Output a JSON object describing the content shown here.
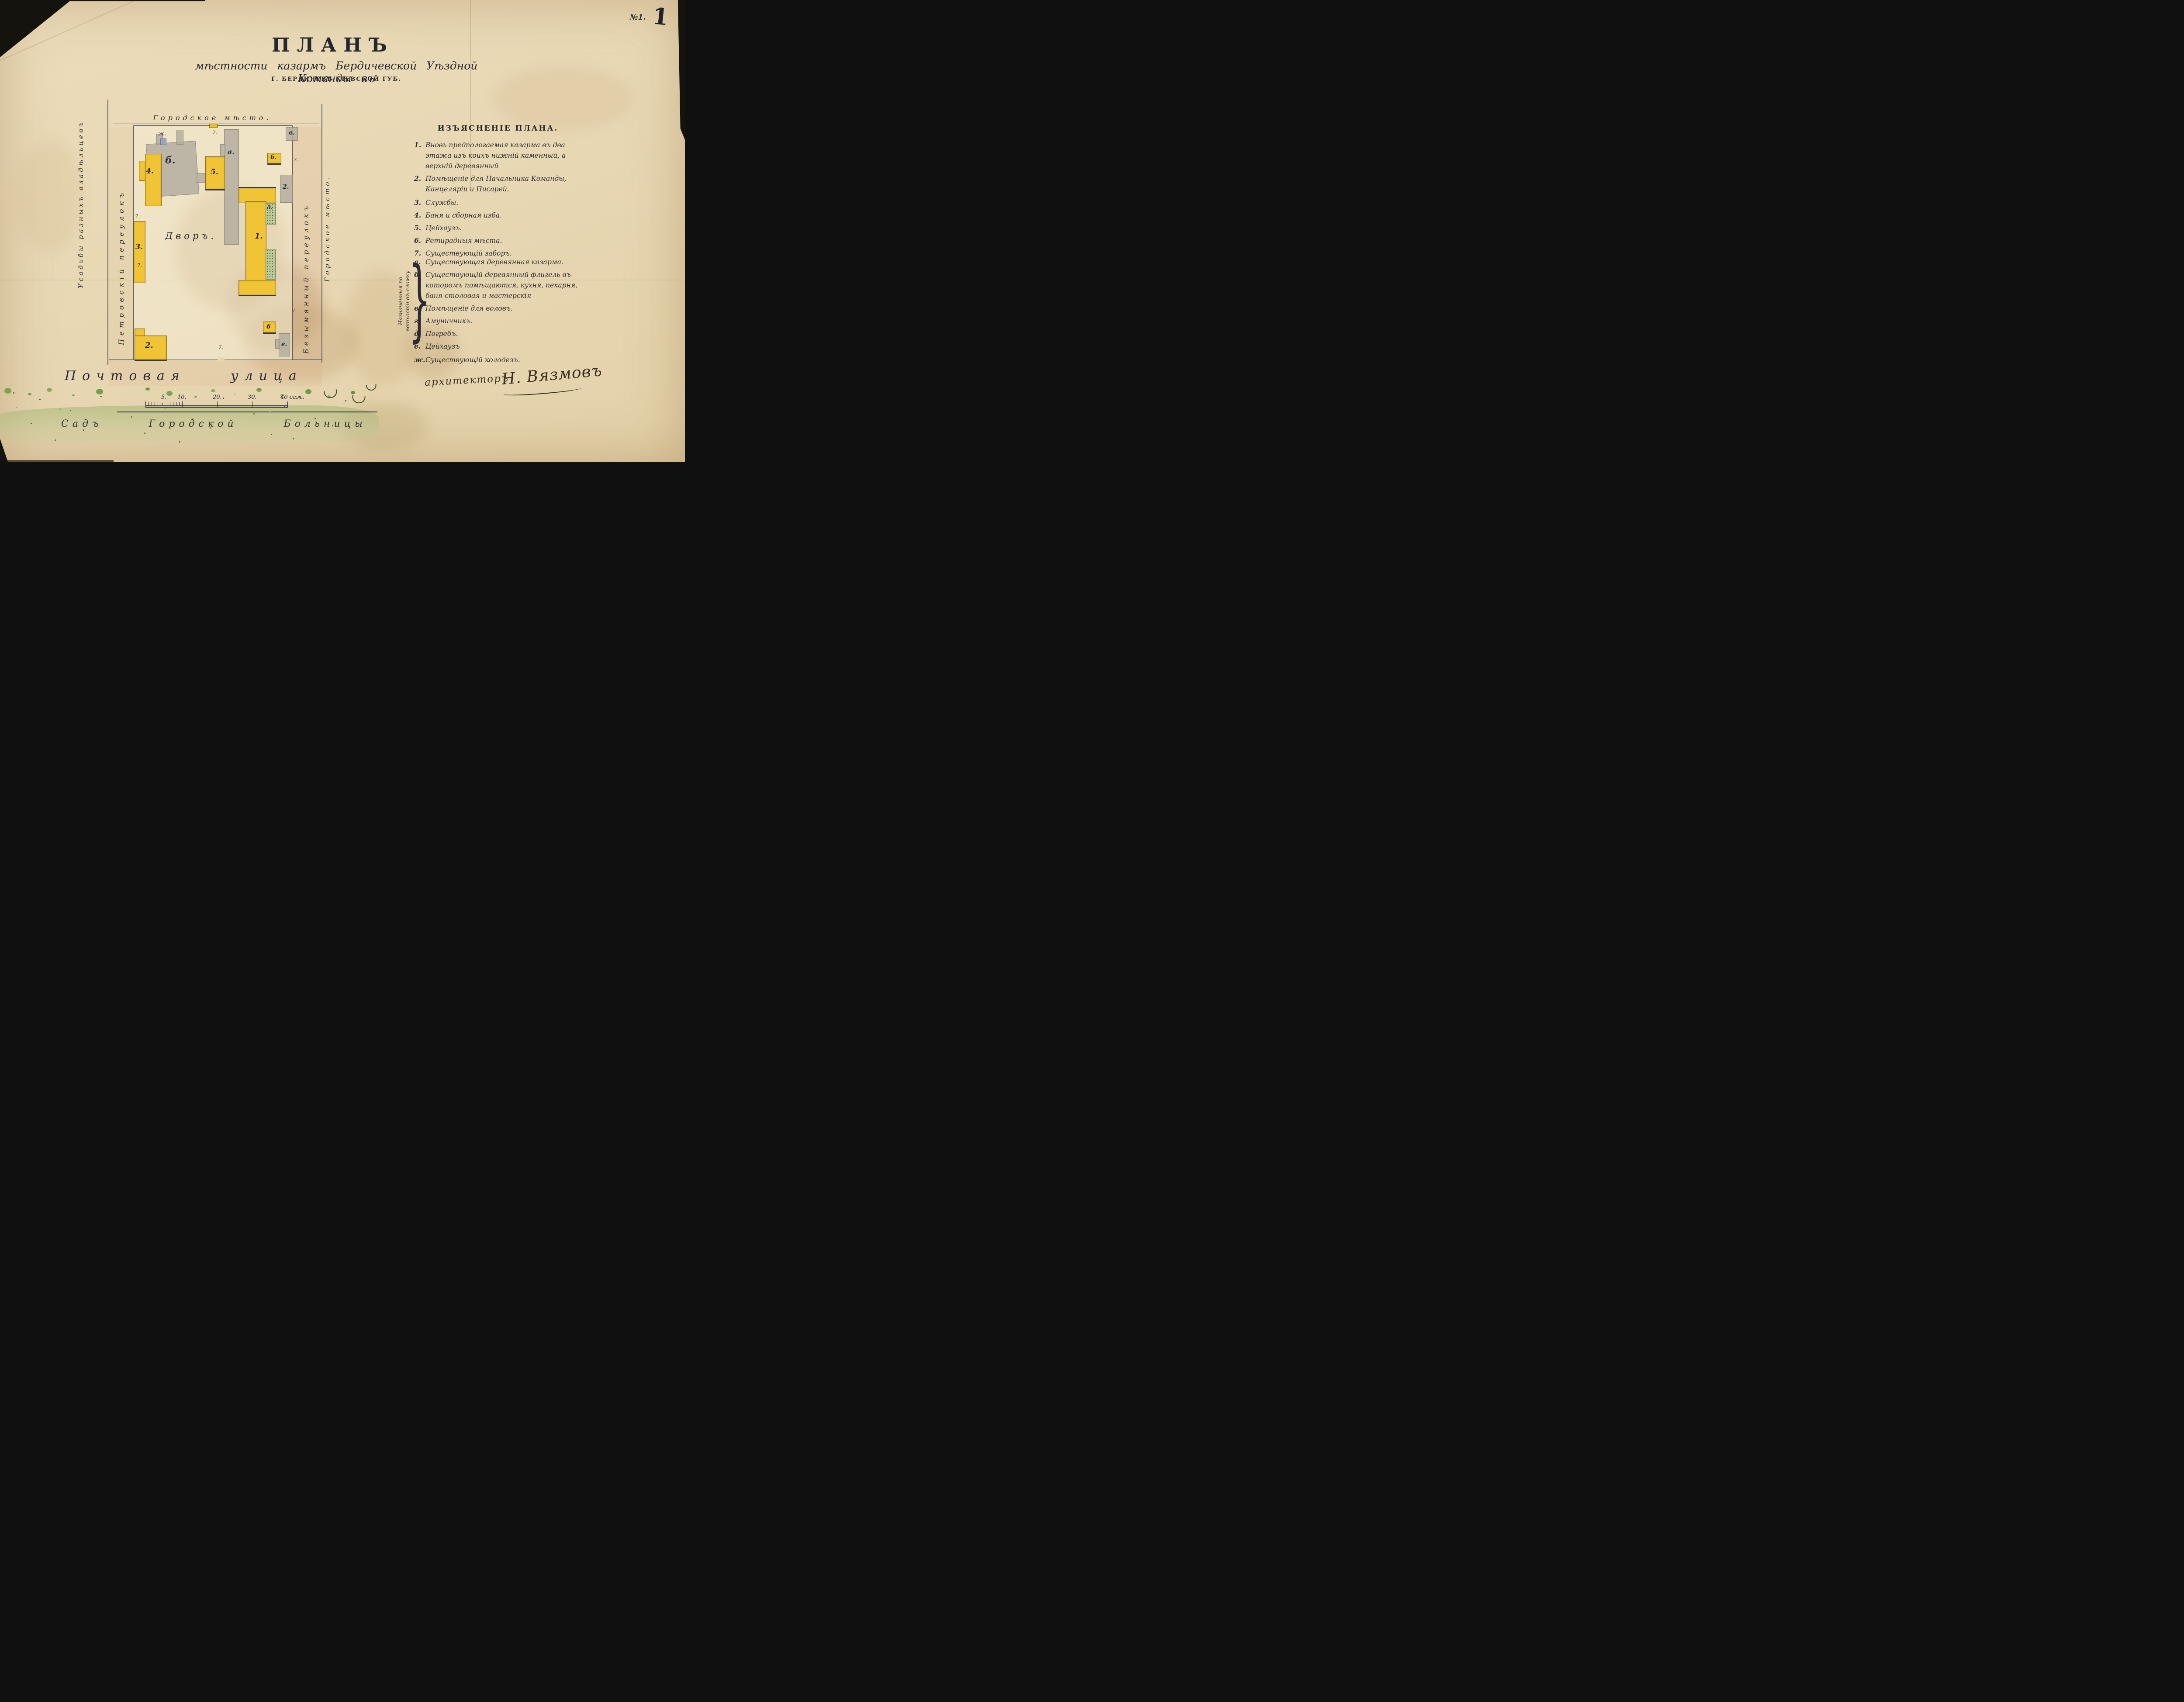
{
  "sheet": {
    "printed_no": "№1.",
    "handwritten_no": "1"
  },
  "title": {
    "main": "ПЛАНЪ",
    "subtitle": "мѣстности казармъ Бердичевской Уѣздной Команды въ",
    "place_line": "Г. БЕРДИЧЕВѢ КІЕВСКОЙ ГУБ."
  },
  "legend": {
    "header": "ИЗЪЯСНЕНІЕ ПЛАНА.",
    "numbered": [
      {
        "num": "1.",
        "text": "Вновь предпологаемая казарма въ два этажа изъ коихъ нижній каменный, а верхній деревянный"
      },
      {
        "num": "2.",
        "text": "Помѣщеніе для Начальника Команды, Канцеляріи и Писарей."
      },
      {
        "num": "3.",
        "text": "Службы."
      },
      {
        "num": "4.",
        "text": "Баня и сборная изба."
      },
      {
        "num": "5.",
        "text": "Цейхаузъ."
      },
      {
        "num": "6.",
        "text": "Ретирадныя мѣста."
      },
      {
        "num": "7.",
        "text": "Существующій заборъ."
      }
    ],
    "demolition_note": "Назначенныя по ветхости въ сломку",
    "lettered": [
      {
        "num": "а.",
        "text": "Существующая деревянная казарма."
      },
      {
        "num": "б.",
        "text": "Существующій деревянный флигель въ которомъ помѣщаются, кухня, пекарня, баня столовая и мастерскія"
      },
      {
        "num": "в.",
        "text": "Помѣщеніе для воловъ."
      },
      {
        "num": "г.",
        "text": "Амуничникъ."
      },
      {
        "num": "д.",
        "text": "Погребъ."
      },
      {
        "num": "е.",
        "text": "Цейхаузъ"
      }
    ],
    "well_item": {
      "num": "ж.",
      "text": "Существующій колодезъ."
    }
  },
  "signature": {
    "role": "архитекторъ",
    "name": "Н. Вязмовъ"
  },
  "plan": {
    "top_area_label": "Городское мѣсто.",
    "left_outer_label": "Усадьбы разныхъ владѣльцевъ",
    "left_lane_label": "Петровскій переулокъ",
    "right_lane_label": "Безымянный переулокъ",
    "right_outer_label": "Городское мѣсто.",
    "yard_label": "Дворъ.",
    "street_label": "Почтовая улица",
    "garden_label": "Садъ Городской Больницы",
    "fence_mark": "7.",
    "well_mark": "ж.",
    "buildings": {
      "b1": "1.",
      "b2": "2.",
      "b2_office": "2.",
      "b3": "3.",
      "b4": "4.",
      "b5": "5.",
      "b6_top": "6.",
      "b6_bottom": "6",
      "a": "а.",
      "b": "б.",
      "v": "в.",
      "d": "д.",
      "e": "е."
    }
  },
  "scalebar": {
    "t5": "5.",
    "t10": "10.",
    "t20": "20.",
    "t30": "30.",
    "t40": "40 саж."
  },
  "colors": {
    "paper": "#e8d8b4",
    "ink": "#2c2c34",
    "new_building_yellow": "#f0c434",
    "existing_building_gray": "#b4aea0",
    "demolition_green": "#bdc99b",
    "garden_green": "#7aa352",
    "well_blue": "#9aa3c2"
  }
}
